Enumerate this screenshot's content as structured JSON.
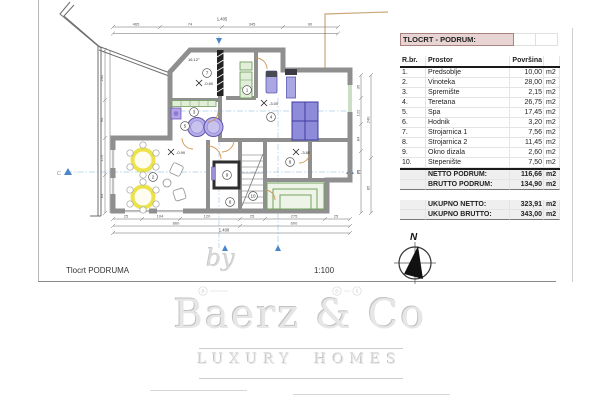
{
  "plan": {
    "footer_title": "Tlocrt PODRUMA",
    "scale": "1:100",
    "compass": "N",
    "section_left": "C",
    "section_right": "C",
    "angle": "16.12°",
    "elevations": [
      "-0.60",
      "-3.00",
      "-0.90",
      "-3.80"
    ],
    "rooms": [
      "1",
      "2",
      "3",
      "4",
      "5",
      "6",
      "7",
      "8",
      "9",
      "10"
    ],
    "dims": {
      "top": [
        "465",
        "74",
        "345",
        "90"
      ],
      "top_total": "1.405",
      "left": [
        "235",
        "90",
        "176",
        "84"
      ],
      "right": [
        "35",
        "122",
        "84",
        "80",
        "240",
        "85"
      ],
      "bottom": [
        "25",
        "104",
        "120",
        "25",
        "275",
        "25"
      ],
      "bottom2": [
        "860",
        "600"
      ],
      "bottom_total": "1.400"
    },
    "bubbles": [
      "B",
      "D",
      "5"
    ]
  },
  "table": {
    "title": "TLOCRT - PODRUM:",
    "columns": {
      "num": "R.br.",
      "name": "Prostor",
      "area": "Površina"
    },
    "rows": [
      {
        "num": "1.",
        "name": "Predsoblje",
        "area": "10,00",
        "unit": "m2"
      },
      {
        "num": "2.",
        "name": "Vinoteka",
        "area": "28,00",
        "unit": "m2"
      },
      {
        "num": "3.",
        "name": "Spremište",
        "area": "2,15",
        "unit": "m2"
      },
      {
        "num": "4.",
        "name": "Teretana",
        "area": "26,75",
        "unit": "m2"
      },
      {
        "num": "5.",
        "name": "Spa",
        "area": "17,45",
        "unit": "m2"
      },
      {
        "num": "6.",
        "name": "Hodnik",
        "area": "3,20",
        "unit": "m2"
      },
      {
        "num": "7.",
        "name": "Strojarnica 1",
        "area": "7,56",
        "unit": "m2"
      },
      {
        "num": "8.",
        "name": "Strojarnica 2",
        "area": "11,45",
        "unit": "m2"
      },
      {
        "num": "9.",
        "name": "Okno dizala",
        "area": "2,60",
        "unit": "m2"
      },
      {
        "num": "10.",
        "name": "Stepenište",
        "area": "7,50",
        "unit": "m2"
      }
    ],
    "subtotals": [
      {
        "label": "NETTO PODRUM:",
        "area": "116,66",
        "unit": "m2"
      },
      {
        "label": "BRUTTO PODRUM:",
        "area": "134,90",
        "unit": "m2"
      }
    ],
    "totals": [
      {
        "label": "UKUPNO NETTO:",
        "area": "323,91",
        "unit": "m2"
      },
      {
        "label": "UKUPNO BRUTTO:",
        "area": "343,00",
        "unit": "m2"
      }
    ]
  },
  "watermark": {
    "by": "by",
    "brand": "Baerz & Co",
    "tagline": "LUXURY HOMES"
  },
  "colors": {
    "wall_gray": "#8f8f8f",
    "hatch_black": "#222222",
    "furniture_purple": "#a5a2e0",
    "accent_green": "#6f9f5f",
    "table_yellow": "#ece249",
    "door_orange": "#cf9757",
    "section_blue": "#4a86c8",
    "header_pink": "#e8d4d2",
    "totals_gray": "#efefef"
  }
}
